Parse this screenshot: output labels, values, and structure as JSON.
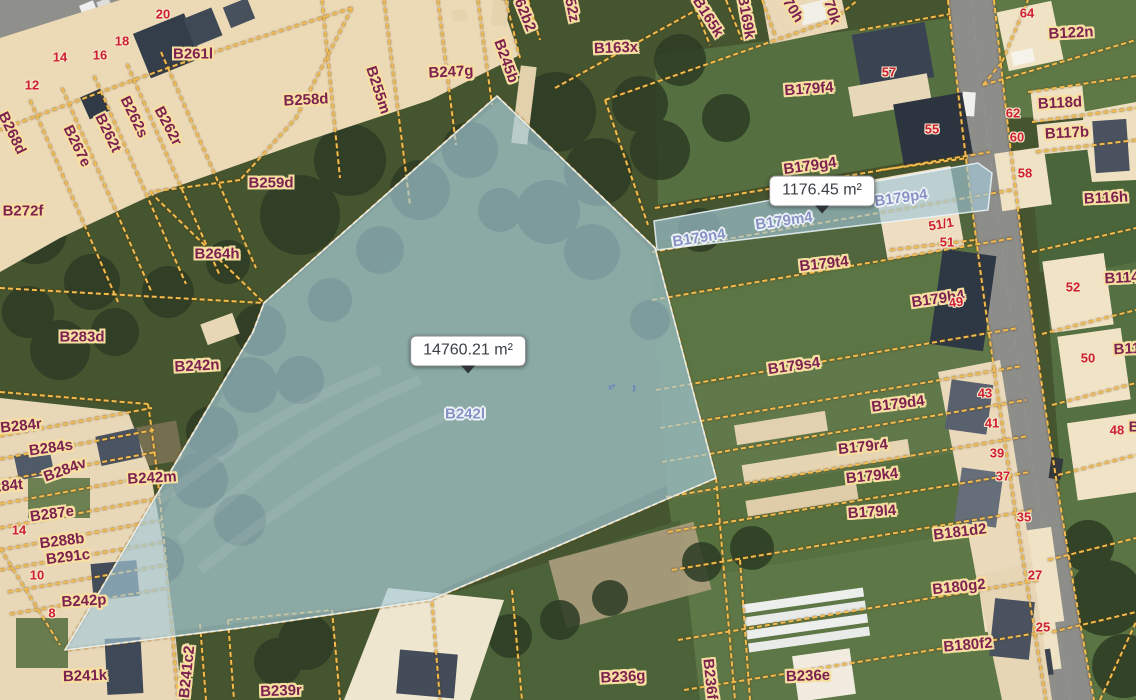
{
  "app": {
    "type": "cadastral-parcel-map-viewer"
  },
  "map": {
    "tooltips": {
      "main": {
        "text": "14760.21 m²",
        "x": 468,
        "y": 351
      },
      "secondary": {
        "text": "1176.45 m²",
        "x": 822,
        "y": 191
      }
    },
    "selection": {
      "parcels": [
        "B242l",
        "B179n4",
        "B179m4",
        "B179p4"
      ]
    },
    "colors": {
      "parcel_line": "#f2bc50",
      "parcel_label": "#7d2150",
      "house_number": "#cf1f34",
      "selected_label": "#8893c5",
      "selection_fill": "#a4cad9",
      "tooltip_bg": "#ffffff",
      "route_line": "#c95fd6"
    },
    "labels": [
      {
        "t": "20",
        "x": 163,
        "y": 14,
        "r": 0,
        "k": "n"
      },
      {
        "t": "18",
        "x": 122,
        "y": 41,
        "r": 0,
        "k": "n"
      },
      {
        "t": "16",
        "x": 100,
        "y": 55,
        "r": 0,
        "k": "n"
      },
      {
        "t": "14",
        "x": 60,
        "y": 57,
        "r": 0,
        "k": "n"
      },
      {
        "t": "12",
        "x": 32,
        "y": 85,
        "r": 0,
        "k": "n"
      },
      {
        "t": "B261l",
        "x": 193,
        "y": 54,
        "r": 0,
        "k": "p"
      },
      {
        "t": "B268d",
        "x": 12,
        "y": 133,
        "r": 64,
        "k": "p"
      },
      {
        "t": "B267e",
        "x": 77,
        "y": 146,
        "r": 64,
        "k": "p"
      },
      {
        "t": "B262t",
        "x": 108,
        "y": 133,
        "r": 64,
        "k": "p"
      },
      {
        "t": "B262s",
        "x": 134,
        "y": 117,
        "r": 64,
        "k": "p"
      },
      {
        "t": "B262r",
        "x": 168,
        "y": 126,
        "r": 62,
        "k": "p"
      },
      {
        "t": "B259d",
        "x": 271,
        "y": 183,
        "r": 0,
        "k": "p"
      },
      {
        "t": "B258d",
        "x": 306,
        "y": 100,
        "r": -3,
        "k": "p"
      },
      {
        "t": "B255m",
        "x": 378,
        "y": 90,
        "r": 72,
        "k": "p"
      },
      {
        "t": "B247g",
        "x": 451,
        "y": 72,
        "r": -3,
        "k": "p"
      },
      {
        "t": "B245b",
        "x": 506,
        "y": 61,
        "r": 70,
        "k": "p"
      },
      {
        "t": "62b2",
        "x": 525,
        "y": 15,
        "r": 68,
        "k": "p"
      },
      {
        "t": "52z",
        "x": 572,
        "y": 10,
        "r": 78,
        "k": "p"
      },
      {
        "t": "B163x",
        "x": 616,
        "y": 48,
        "r": -2,
        "k": "p"
      },
      {
        "t": "B165k",
        "x": 708,
        "y": 17,
        "r": 58,
        "k": "p"
      },
      {
        "t": "B169k",
        "x": 746,
        "y": 17,
        "r": 80,
        "k": "p"
      },
      {
        "t": "70h",
        "x": 793,
        "y": 10,
        "r": 58,
        "k": "p"
      },
      {
        "t": "70k",
        "x": 832,
        "y": 12,
        "r": 72,
        "k": "p"
      },
      {
        "t": "B179f4",
        "x": 809,
        "y": 89,
        "r": -4,
        "k": "p"
      },
      {
        "t": "57",
        "x": 889,
        "y": 72,
        "r": 0,
        "k": "n"
      },
      {
        "t": "64",
        "x": 1027,
        "y": 13,
        "r": 0,
        "k": "n"
      },
      {
        "t": "B122n",
        "x": 1071,
        "y": 33,
        "r": -3,
        "k": "p"
      },
      {
        "t": "62",
        "x": 1013,
        "y": 113,
        "r": 0,
        "k": "n"
      },
      {
        "t": "B118d",
        "x": 1060,
        "y": 103,
        "r": -3,
        "k": "p"
      },
      {
        "t": "60",
        "x": 1017,
        "y": 137,
        "r": 0,
        "k": "n"
      },
      {
        "t": "B117b",
        "x": 1067,
        "y": 133,
        "r": -3,
        "k": "p"
      },
      {
        "t": "55",
        "x": 932,
        "y": 129,
        "r": 0,
        "k": "n"
      },
      {
        "t": "58",
        "x": 1025,
        "y": 173,
        "r": 0,
        "k": "n"
      },
      {
        "t": "B116h",
        "x": 1106,
        "y": 198,
        "r": -3,
        "k": "p"
      },
      {
        "t": "B179g4",
        "x": 810,
        "y": 166,
        "r": -8,
        "k": "p"
      },
      {
        "t": "B179p4",
        "x": 901,
        "y": 198,
        "r": -8,
        "k": "s"
      },
      {
        "t": "B179m4",
        "x": 784,
        "y": 221,
        "r": -8,
        "k": "s"
      },
      {
        "t": "B179n4",
        "x": 699,
        "y": 238,
        "r": -9,
        "k": "s"
      },
      {
        "t": "B179t4",
        "x": 824,
        "y": 264,
        "r": -6,
        "k": "p"
      },
      {
        "t": "51/1",
        "x": 941,
        "y": 224,
        "r": -10,
        "k": "n"
      },
      {
        "t": "51",
        "x": 947,
        "y": 242,
        "r": 0,
        "k": "n"
      },
      {
        "t": "B179h4",
        "x": 938,
        "y": 299,
        "r": -8,
        "k": "p"
      },
      {
        "t": "49",
        "x": 956,
        "y": 302,
        "r": -8,
        "k": "n"
      },
      {
        "t": "52",
        "x": 1073,
        "y": 287,
        "r": 0,
        "k": "n"
      },
      {
        "t": "B114",
        "x": 1122,
        "y": 278,
        "r": -3,
        "k": "p"
      },
      {
        "t": "50",
        "x": 1088,
        "y": 358,
        "r": 0,
        "k": "n"
      },
      {
        "t": "B11",
        "x": 1127,
        "y": 349,
        "r": -3,
        "k": "p"
      },
      {
        "t": "48",
        "x": 1117,
        "y": 430,
        "r": 0,
        "k": "n"
      },
      {
        "t": "B",
        "x": 1134,
        "y": 427,
        "r": 0,
        "k": "p"
      },
      {
        "t": "B179s4",
        "x": 794,
        "y": 366,
        "r": -8,
        "k": "p"
      },
      {
        "t": "B179d4",
        "x": 898,
        "y": 404,
        "r": -7,
        "k": "p"
      },
      {
        "t": "43",
        "x": 985,
        "y": 393,
        "r": 0,
        "k": "n"
      },
      {
        "t": "B179r4",
        "x": 863,
        "y": 447,
        "r": -6,
        "k": "p"
      },
      {
        "t": "41",
        "x": 992,
        "y": 423,
        "r": 0,
        "k": "n"
      },
      {
        "t": "B179k4",
        "x": 872,
        "y": 476,
        "r": -6,
        "k": "p"
      },
      {
        "t": "39",
        "x": 997,
        "y": 453,
        "r": 0,
        "k": "n"
      },
      {
        "t": "37",
        "x": 1003,
        "y": 476,
        "r": 0,
        "k": "n"
      },
      {
        "t": "B179l4",
        "x": 872,
        "y": 512,
        "r": -4,
        "k": "p"
      },
      {
        "t": "35",
        "x": 1024,
        "y": 517,
        "r": 0,
        "k": "n"
      },
      {
        "t": "B181d2",
        "x": 960,
        "y": 532,
        "r": -7,
        "k": "p"
      },
      {
        "t": "27",
        "x": 1035,
        "y": 575,
        "r": 0,
        "k": "n"
      },
      {
        "t": "B180g2",
        "x": 959,
        "y": 587,
        "r": -6,
        "k": "p"
      },
      {
        "t": "25",
        "x": 1043,
        "y": 627,
        "r": 0,
        "k": "n"
      },
      {
        "t": "B180f2",
        "x": 968,
        "y": 645,
        "r": -5,
        "k": "p"
      },
      {
        "t": "B272f",
        "x": 23,
        "y": 211,
        "r": 0,
        "k": "p"
      },
      {
        "t": "B264h",
        "x": 217,
        "y": 254,
        "r": 0,
        "k": "p"
      },
      {
        "t": "B283d",
        "x": 82,
        "y": 337,
        "r": 0,
        "k": "p"
      },
      {
        "t": "B242n",
        "x": 197,
        "y": 366,
        "r": -3,
        "k": "p"
      },
      {
        "t": "B242m",
        "x": 152,
        "y": 478,
        "r": -3,
        "k": "p"
      },
      {
        "t": "B242l",
        "x": 465,
        "y": 414,
        "r": 0,
        "k": "s"
      },
      {
        "t": "B284r",
        "x": 21,
        "y": 426,
        "r": -6,
        "k": "p"
      },
      {
        "t": "B284s",
        "x": 51,
        "y": 448,
        "r": -8,
        "k": "p"
      },
      {
        "t": "B284v",
        "x": 65,
        "y": 470,
        "r": -20,
        "k": "p"
      },
      {
        "t": "284t",
        "x": 8,
        "y": 486,
        "r": -6,
        "k": "p"
      },
      {
        "t": "B287e",
        "x": 52,
        "y": 514,
        "r": -8,
        "k": "p"
      },
      {
        "t": "14",
        "x": 19,
        "y": 530,
        "r": 0,
        "k": "n"
      },
      {
        "t": "B288b",
        "x": 62,
        "y": 541,
        "r": -7,
        "k": "p"
      },
      {
        "t": "B291c",
        "x": 68,
        "y": 557,
        "r": -7,
        "k": "p"
      },
      {
        "t": "10",
        "x": 37,
        "y": 575,
        "r": 0,
        "k": "n"
      },
      {
        "t": "B242p",
        "x": 84,
        "y": 601,
        "r": -3,
        "k": "p"
      },
      {
        "t": "8",
        "x": 52,
        "y": 613,
        "r": 0,
        "k": "n"
      },
      {
        "t": "B241k",
        "x": 85,
        "y": 676,
        "r": -2,
        "k": "p"
      },
      {
        "t": "4",
        "x": 186,
        "y": 649,
        "r": -4,
        "k": "n"
      },
      {
        "t": "B241c2",
        "x": 187,
        "y": 672,
        "r": -84,
        "k": "p"
      },
      {
        "t": "B239r",
        "x": 281,
        "y": 691,
        "r": -2,
        "k": "p"
      },
      {
        "t": "B236g",
        "x": 623,
        "y": 677,
        "r": -3,
        "k": "p"
      },
      {
        "t": "B236f",
        "x": 710,
        "y": 679,
        "r": 84,
        "k": "p"
      },
      {
        "t": "B236e",
        "x": 808,
        "y": 676,
        "r": -2,
        "k": "p"
      },
      {
        "t": "x³'",
        "x": 612,
        "y": 388,
        "r": 0,
        "k": "m"
      },
      {
        "t": "¦i",
        "x": 634,
        "y": 389,
        "r": 0,
        "k": "m"
      }
    ]
  }
}
